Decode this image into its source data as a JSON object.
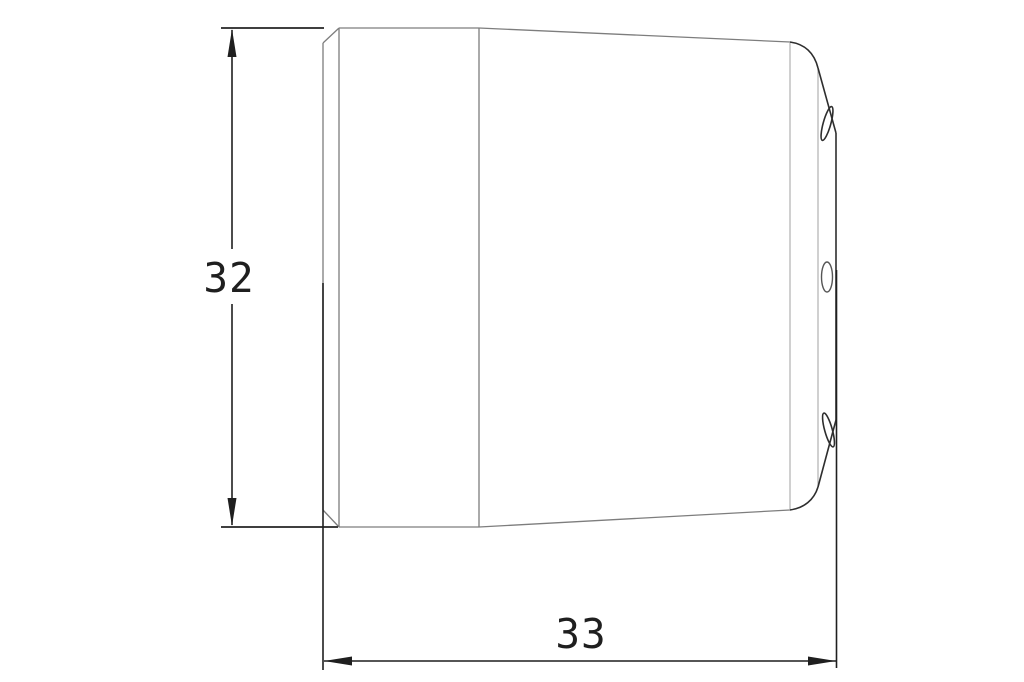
{
  "drawing": {
    "type": "technical-drawing-side-view",
    "dimensions": {
      "height": {
        "label": "32"
      },
      "width": {
        "label": "33"
      }
    }
  },
  "colors": {
    "background": "#ffffff",
    "object_line": "#7d7d7d",
    "object_line_light": "#b0b0b0",
    "outline_dark": "#2e2e2e",
    "hole_line": "#555555",
    "extension_line": "#3f3f3f",
    "dimension_line": "#1f1f1f",
    "text": "#1f1f1f"
  }
}
